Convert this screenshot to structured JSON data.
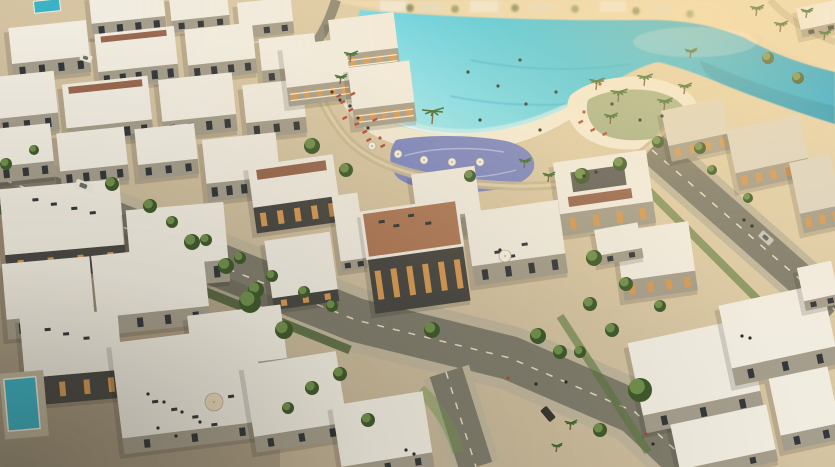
{
  "scene": {
    "type": "aerial-architectural-render",
    "description": "Aerial rendering of a waterfront villa community: turquoise crystal lagoon with sandy beach cove, sun loungers and palm trees, white modern villas with rooftop terraces and terracotta decks, tree-lined boulevards with cars and pedestrians",
    "labels": {
      "lagoon": "Crystal lagoon",
      "beach": "Beach cove with sun loungers",
      "splash_pad": "Water playground",
      "palm_peninsula": "Palm beach peninsula",
      "channel": "Lagoon channel",
      "far_shore": "Hazy far shore with distant villas",
      "villas": "White villas with rooftop terraces",
      "boulevard": "Tree-lined boulevard",
      "rooftop_terraces": "Rooftop lounge terraces",
      "plunge_pool": "Private plunge pool",
      "promenade": "Lagoon promenade"
    },
    "palette": {
      "ground_dim": "#b3a68c",
      "ground_mid": "#d2c1a0",
      "ground_bright": "#ecd9b0",
      "lagoon_shallow": "#9fe9f0",
      "lagoon": "#3ec8e6",
      "lagoon_deep": "#1d9eca",
      "channel": "#17708f",
      "beach": "#f3ebd6",
      "splash_pad": "#7b86c2",
      "path": "#c9b896",
      "road": "#807d6d",
      "sidewalk": "#c0b69c",
      "lane": "#ece6d2",
      "roof_white": "#f1ece0",
      "roof_shade": "#ddd5c2",
      "wall_light": "#e3dbc6",
      "wall_shadow": "#a59e8c",
      "wall_dark": "#494843",
      "window_warm": "#d59a56",
      "window_dark": "#34383a",
      "deck": "#99684f",
      "deck_bright": "#ad7857",
      "tree": "#5a793d",
      "tree_dark": "#3f5a2c",
      "tree_light": "#7a9a52",
      "palm": "#3e6a33",
      "trunk": "#7a5c3e",
      "pool": "#3bb3c6",
      "car_white": "#ebe8dc",
      "car_silver": "#c6c3b8",
      "car_dark": "#39372f",
      "person": "#2f2d27",
      "accent_red": "#b04a38",
      "umbrella_white": "#f5efdf",
      "glow": "#ffde9e",
      "vignette": "#241f16"
    }
  }
}
